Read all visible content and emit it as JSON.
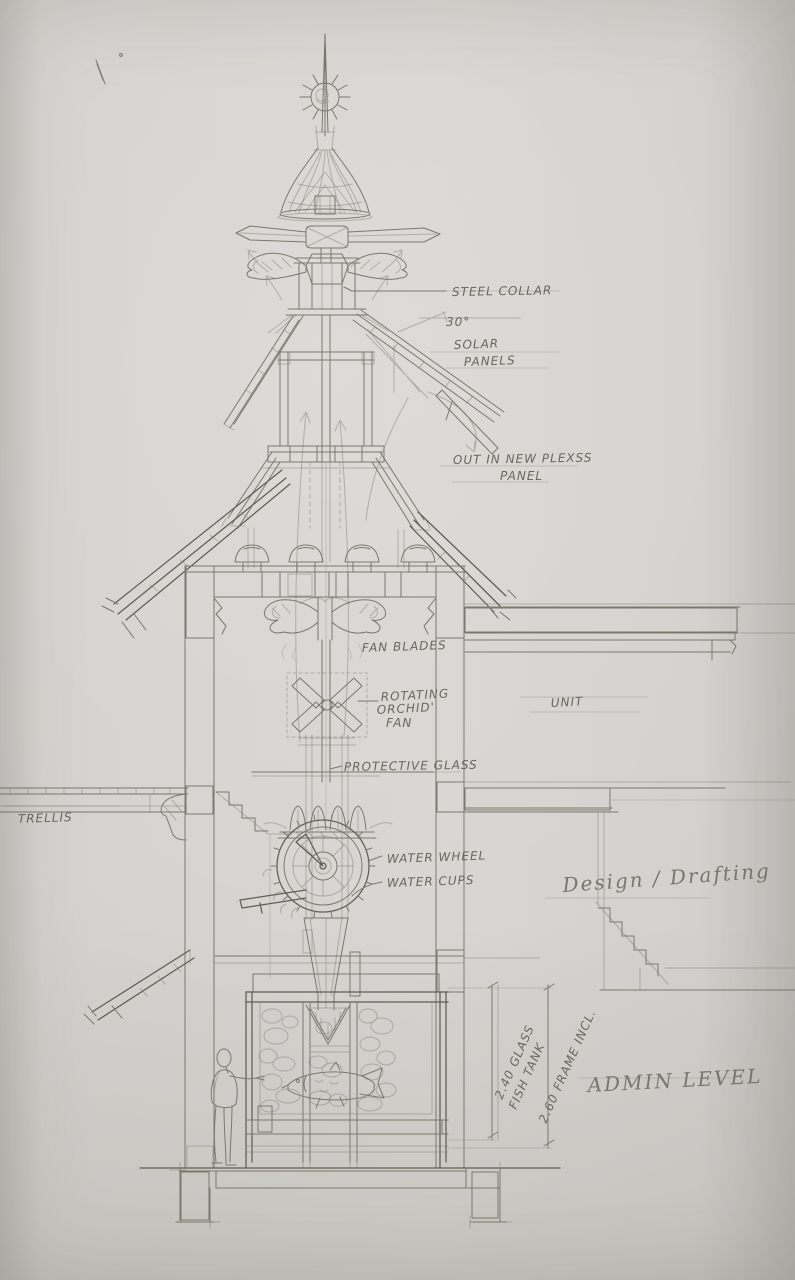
{
  "document": {
    "kind": "hand-drawn pencil architectural section sketch",
    "subject": "tower section with wind spire, solar panels, water wheel and fish tank"
  },
  "palette": {
    "paper": "#d5d3cf",
    "pencil": "#7c786d",
    "pencil_dark": "#615d52",
    "red_mark": "#8a4a2e"
  },
  "annotations": {
    "steel_collar": "STEEL COLLAR",
    "solar_angle": "30°",
    "solar_line1": "SOLAR",
    "solar_line2": "PANELS",
    "out_line1": "OUT IN NEW PLEXSS",
    "out_line2": "PANEL",
    "fan_blades": "FAN BLADES",
    "rotating_line1": "ROTATING",
    "rotating_line2": "ORCHID'",
    "rotating_line3": "FAN",
    "protective_glass": "PROTECTIVE GLASS",
    "unit": "UNIT",
    "trellis": "TRELLIS",
    "water_wheel": "WATER WHEEL",
    "water_cups": "WATER CUPS",
    "design_drafting": "Design / Drafting",
    "tank_dim_line1": "2.40 GLASS",
    "tank_dim_line2": "FISH TANK",
    "tank_frame_dim": "2.60 FRAME INCL.",
    "admin_level": "ADMIN LEVEL"
  }
}
